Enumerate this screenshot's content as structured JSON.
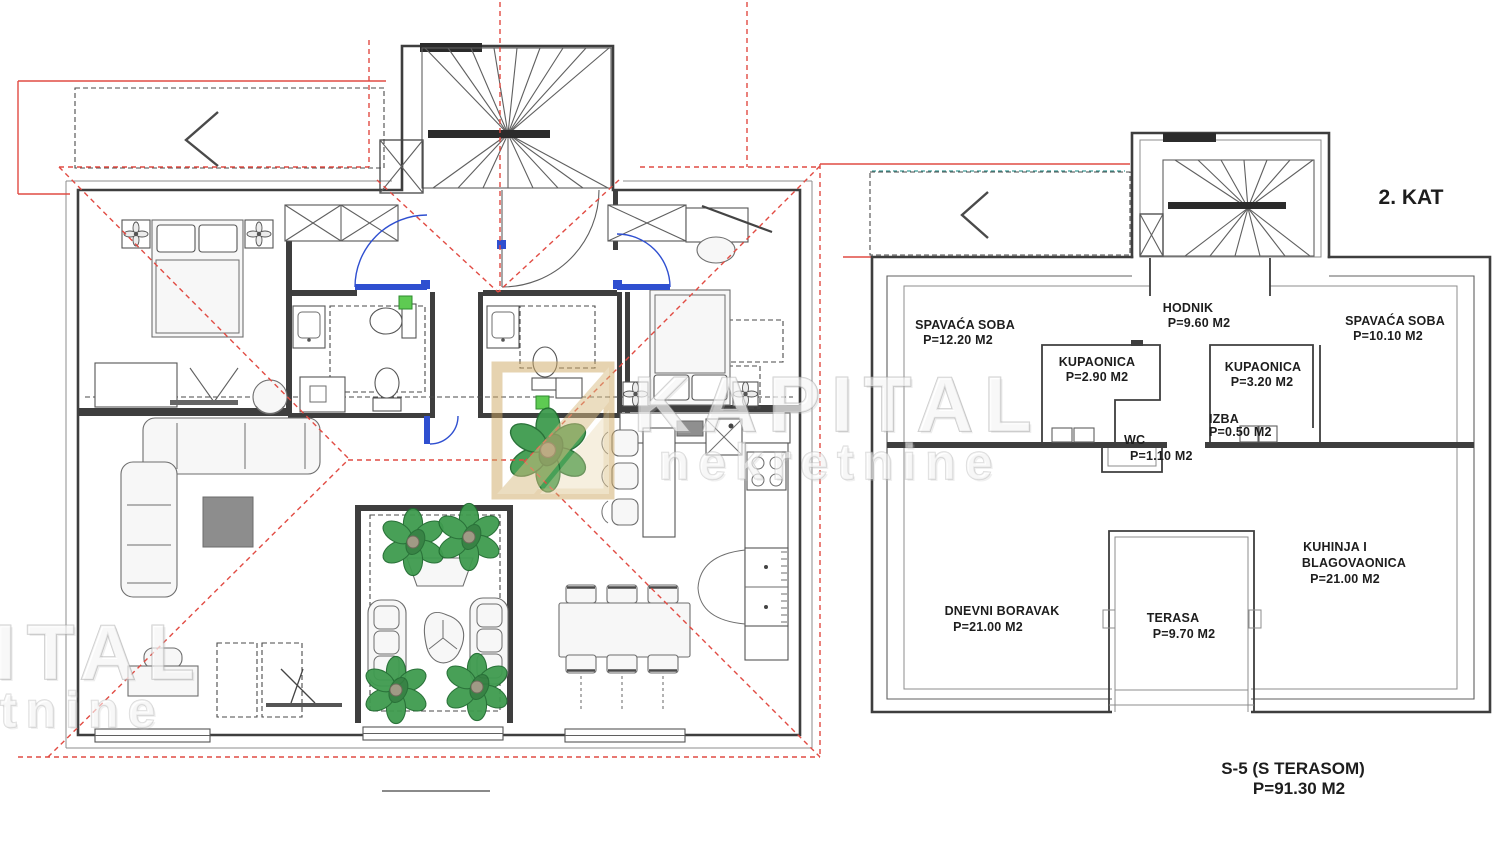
{
  "watermark": {
    "brand": "KAPITAL",
    "subtitle": "nekretnine"
  },
  "floor_label": "2. KAT",
  "unit": {
    "label": "S-5 (S TERASOM)",
    "area": "P=91.30 M2"
  },
  "rooms": [
    {
      "name": "SPAVAĆA SOBA",
      "area": "P=12.20 M2"
    },
    {
      "name": "HODNIK",
      "area": "P=9.60 M2"
    },
    {
      "name": "SPAVAĆA SOBA",
      "area": "P=10.10 M2"
    },
    {
      "name": "KUPAONICA",
      "area": "P=2.90 M2"
    },
    {
      "name": "KUPAONICA",
      "area": "P=3.20 M2"
    },
    {
      "name": "IZBA",
      "area": "P=0.50 M2"
    },
    {
      "name": "WC",
      "area": "P=1.10 M2"
    },
    {
      "name_line1": "KUHINJA I",
      "name_line2": "BLAGOVAONICA",
      "area": "P=21.00 M2"
    },
    {
      "name": "DNEVNI BORAVAK",
      "area": "P=21.00 M2"
    },
    {
      "name": "TERASA",
      "area": "P=9.70 M2"
    }
  ],
  "colors": {
    "roof_projection_line": "#e14b43",
    "door_swing": "#2f4fd0",
    "plant_green": "#3f9b4f",
    "teal_line": "#3d9e99",
    "watermark_logo_tan": "#cfa963",
    "wall_dark": "#3e3e3e"
  }
}
